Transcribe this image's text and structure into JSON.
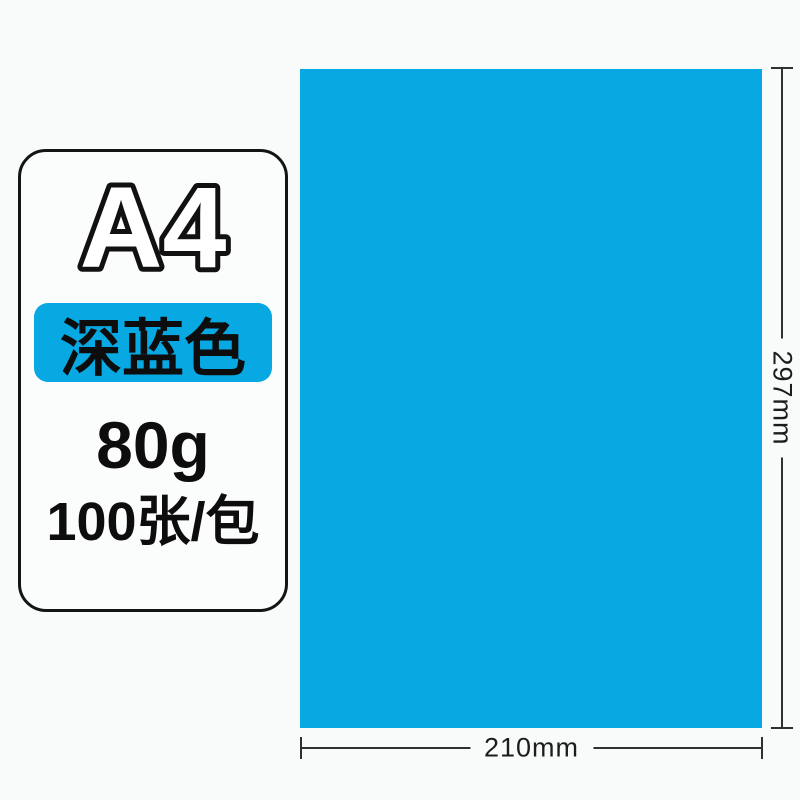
{
  "page": {
    "background_color": "#f9fafa",
    "accent_blue": "#08a8e3",
    "line_color": "#303030"
  },
  "product_card": {
    "size_label": "A4",
    "color_badge_label": "深蓝色",
    "weight_label": "80g",
    "quantity_label": "100张/包"
  },
  "paper_sheet": {
    "color_hex": "#08a8e3"
  },
  "dimensions": {
    "height_label": "297mm",
    "width_label": "210mm"
  }
}
